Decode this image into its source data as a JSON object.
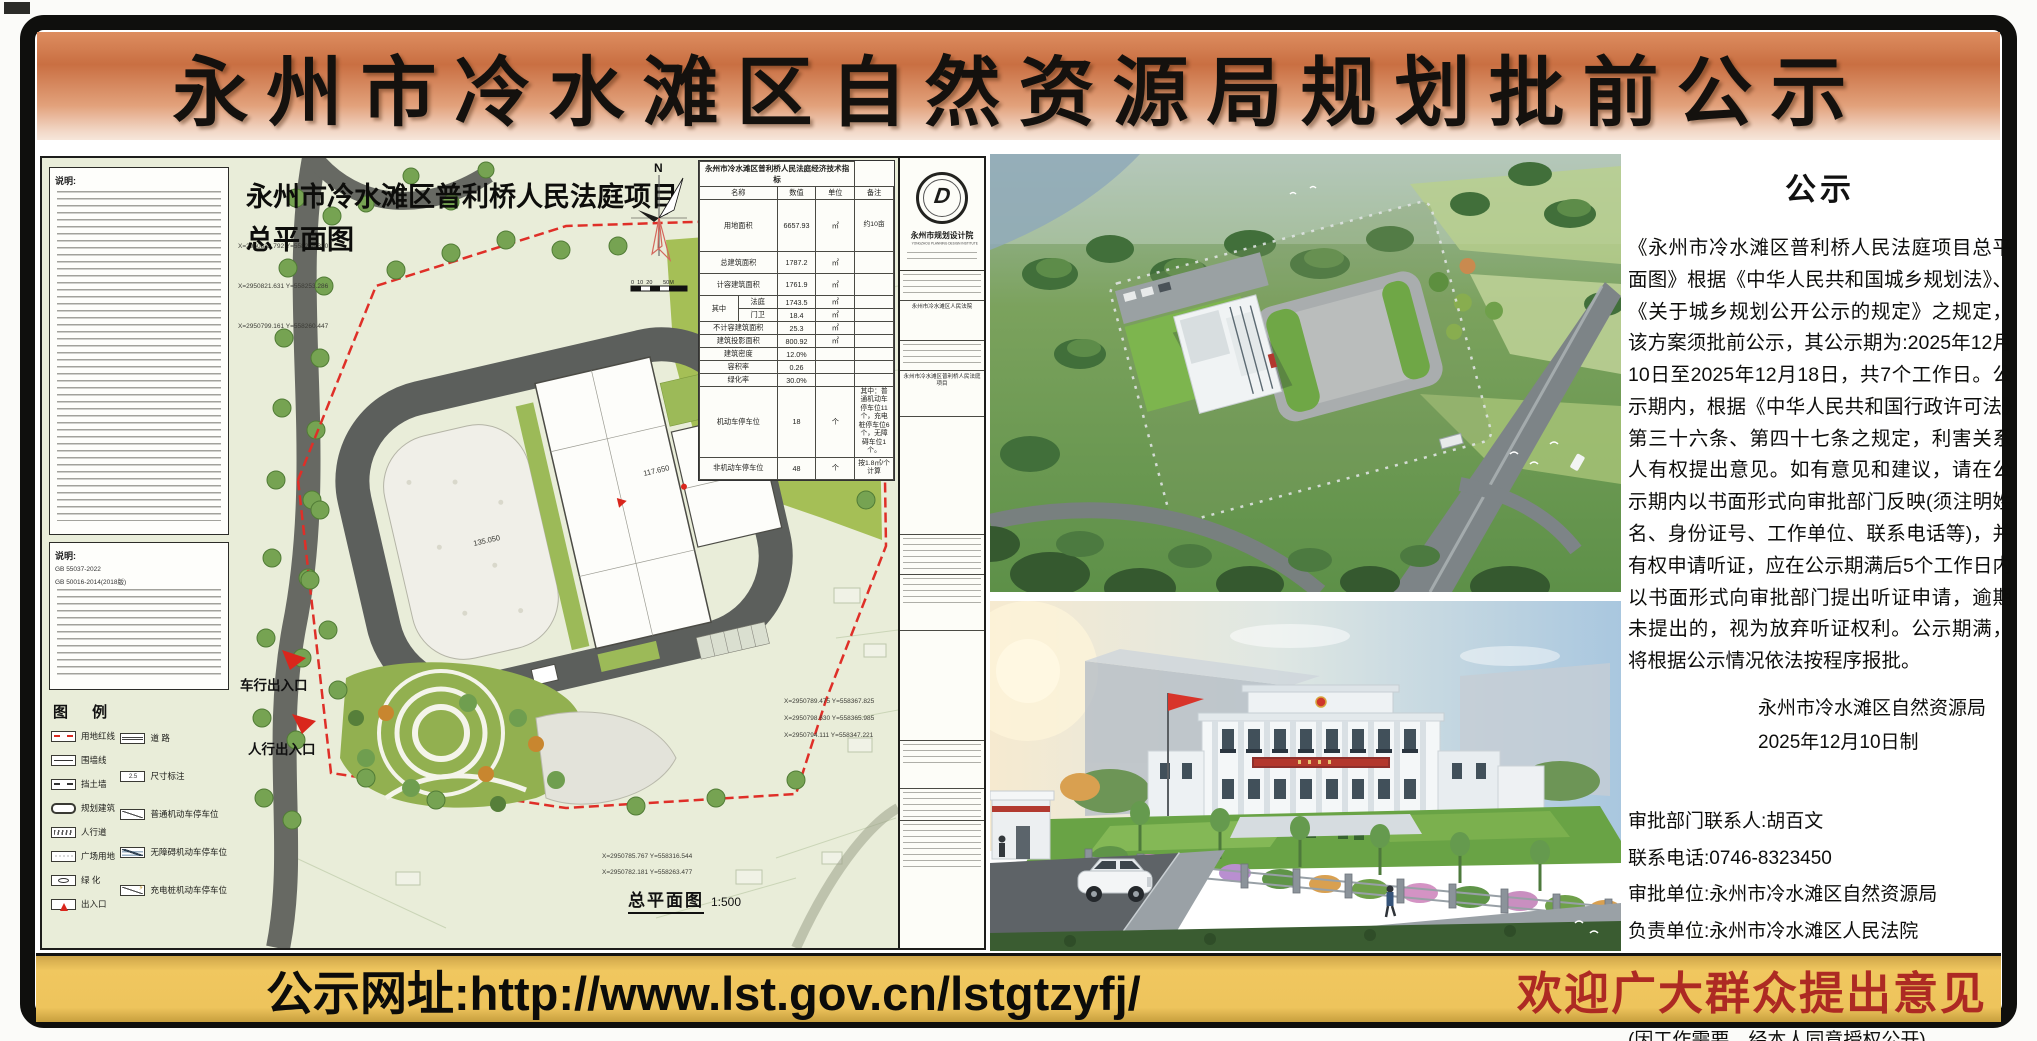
{
  "banner": {
    "title": "永州市冷水滩区自然资源局规划批前公示"
  },
  "footer": {
    "url": "公示网址:http://www.lst.gov.cn/lstgtzyfj/",
    "slogan": "欢迎广大群众提出意见"
  },
  "colors": {
    "banner_orange": "#c96f42",
    "footer_gold": "#eec45c",
    "slogan_red": "#ad2a23",
    "boundary_red": "#df2f28",
    "plan_background": "#e9edd9"
  },
  "drawing": {
    "overlay_title_line1": "永州市冷水滩区普利桥人民法庭项目",
    "overlay_title_line2": "总平面图",
    "bottom_label": "总平面图",
    "bottom_scale": "1:500",
    "north_label": "N",
    "scalebar": "0  10  20       50M",
    "notes1_heading": "说明:",
    "notes2_heading": "说明:",
    "notes2_ref1": "GB 55037-2022",
    "notes2_ref2": "GB 50016-2014(2018版)",
    "entrances": [
      "车行出入口",
      "人行出入口"
    ],
    "spot_levels": [
      "135.050",
      "117.650"
    ],
    "coords": [
      "X=2950832.792 Y=558258.320",
      "X=2950821.631 Y=558253.286",
      "X=2950799.161 Y=558260.447",
      "X=2950789.475 Y=558367.825",
      "X=2950798.630 Y=558365.985",
      "X=2950794.111 Y=558347.221",
      "X=2950785.767 Y=558316.544",
      "X=2950782.181 Y=558263.477"
    ],
    "legend": {
      "heading": "图 例",
      "left": [
        "用地红线",
        "围墙线",
        "挡土墙",
        "规划建筑",
        "人行道",
        "广场用地",
        "绿 化",
        "出入口"
      ],
      "right": [
        "道 路",
        "尺寸标注",
        "普通机动车停车位",
        "无障碍机动车停车位",
        "充电桩机动车停车位"
      ]
    },
    "table": {
      "title": "永州市冷水滩区普利桥人民法庭经济技术指标",
      "headers": [
        "名称",
        "数值",
        "单位",
        "备注"
      ],
      "group_label": "其中",
      "rows": [
        {
          "name": "用地面积",
          "value": "6657.93",
          "unit": "㎡",
          "note": "约10亩"
        },
        {
          "name": "总建筑面积",
          "value": "1787.2",
          "unit": "㎡",
          "note": ""
        },
        {
          "name": "计容建筑面积",
          "value": "1761.9",
          "unit": "㎡",
          "note": ""
        },
        {
          "name": "法庭",
          "value": "1743.5",
          "unit": "㎡",
          "note": ""
        },
        {
          "name": "门卫",
          "value": "18.4",
          "unit": "㎡",
          "note": ""
        },
        {
          "name": "不计容建筑面积",
          "value": "25.3",
          "unit": "㎡",
          "note": ""
        },
        {
          "name": "建筑投影面积",
          "value": "800.92",
          "unit": "㎡",
          "note": ""
        },
        {
          "name": "建筑密度",
          "value": "12.0%",
          "unit": "",
          "note": ""
        },
        {
          "name": "容积率",
          "value": "0.26",
          "unit": "",
          "note": ""
        },
        {
          "name": "绿化率",
          "value": "30.0%",
          "unit": "",
          "note": ""
        },
        {
          "name": "机动车停车位",
          "value": "18",
          "unit": "个",
          "note": "其中：普通机动车停车位11个，充电桩停车位6个，无障碍车位1个。"
        },
        {
          "name": "非机动车停车位",
          "value": "48",
          "unit": "个",
          "note": "按1.8㎡/个计算"
        }
      ]
    },
    "stamp": {
      "letter": "D",
      "name_cn": "永州市规划设计院",
      "name_en": "YONGZHOU PLANNING DESIGN INSTITUTE"
    },
    "titleblock": {
      "owner": "永州市冷水滩区人民法院",
      "project": "永州市冷水滩区普利桥人民法庭项目"
    }
  },
  "notice": {
    "heading": "公示",
    "body": "《永州市冷水滩区普利桥人民法庭项目总平面图》根据《中华人民共和国城乡规划法》、《关于城乡规划公开公示的规定》之规定，该方案须批前公示，其公示期为:2025年12月10日至2025年12月18日，共7个工作日。公示期内，根据《中华人民共和国行政许可法》第三十六条、第四十七条之规定，利害关系人有权提出意见。如有意见和建议，请在公示期内以书面形式向审批部门反映(须注明姓名、身份证号、工作单位、联系电话等)，并有权申请听证，应在公示期满后5个工作日内以书面形式向审批部门提出听证申请，逾期未提出的，视为放弃听证权利。公示期满，将根据公示情况依法按程序报批。",
    "sign_org": "永州市冷水滩区自然资源局",
    "sign_date": "2025年12月10日制",
    "contacts": [
      "审批部门联系人:胡百文",
      "联系电话:0746-8323450",
      "审批单位:永州市冷水滩区自然资源局",
      "负责单位:永州市冷水滩区人民法院",
      "联系人:周进武",
      "联系电话:18874610911",
      "(因工作需要，经本人同意授权公开)"
    ]
  }
}
